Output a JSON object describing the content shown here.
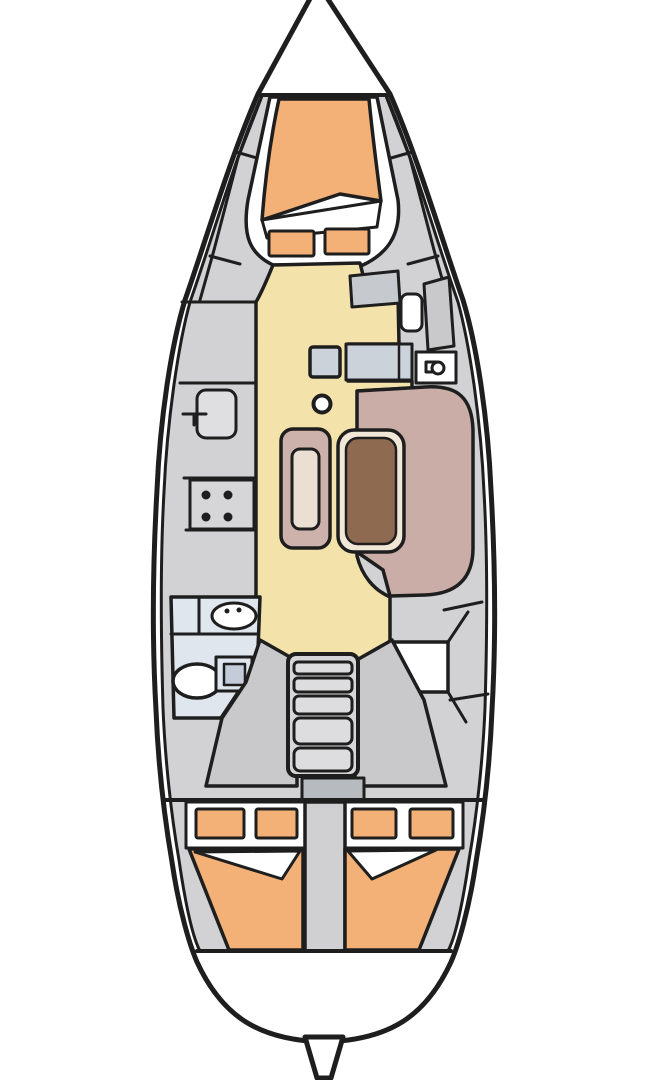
{
  "diagram": {
    "type": "sailboat-interior-floor-plan",
    "orientation": "bow-up",
    "regions": [
      "bow-anchor-locker",
      "forward-v-berth-cabin",
      "salon-floor",
      "galley-port",
      "head-bathroom-port",
      "navigation-station-starboard",
      "dinette-settee-starboard",
      "companionway-ladder",
      "engine-hatch",
      "aft-cabin-port",
      "aft-cabin-starboard",
      "stern-transom",
      "rudder-post"
    ]
  },
  "colors": {
    "outline": "#1e1e1e",
    "hull": "#ffffff",
    "side_deck": "#d2d2d4",
    "panel": "#c9c9cc",
    "floor": "#f3e3ab",
    "cushion": "#f4b177",
    "settee": "#c9ada6",
    "bench": "#cdb2ab",
    "bench_pad": "#eadfd2",
    "table_top": "#8d6a50",
    "table_trim": "#f0e7d6",
    "head_room": "#dfe6ee",
    "shower": "#c3ccd8",
    "fixture": "#ffffff",
    "counter": "#dfdfe1",
    "stove": "#d6d6d8",
    "burner": "#1e1e1e",
    "mast": "#ccd2da",
    "desk": "#c6c9ce",
    "ladder": "#d6d6d8",
    "step": "#dddde0",
    "hatch": "#b7babf",
    "divider": "#d0d0d2"
  }
}
